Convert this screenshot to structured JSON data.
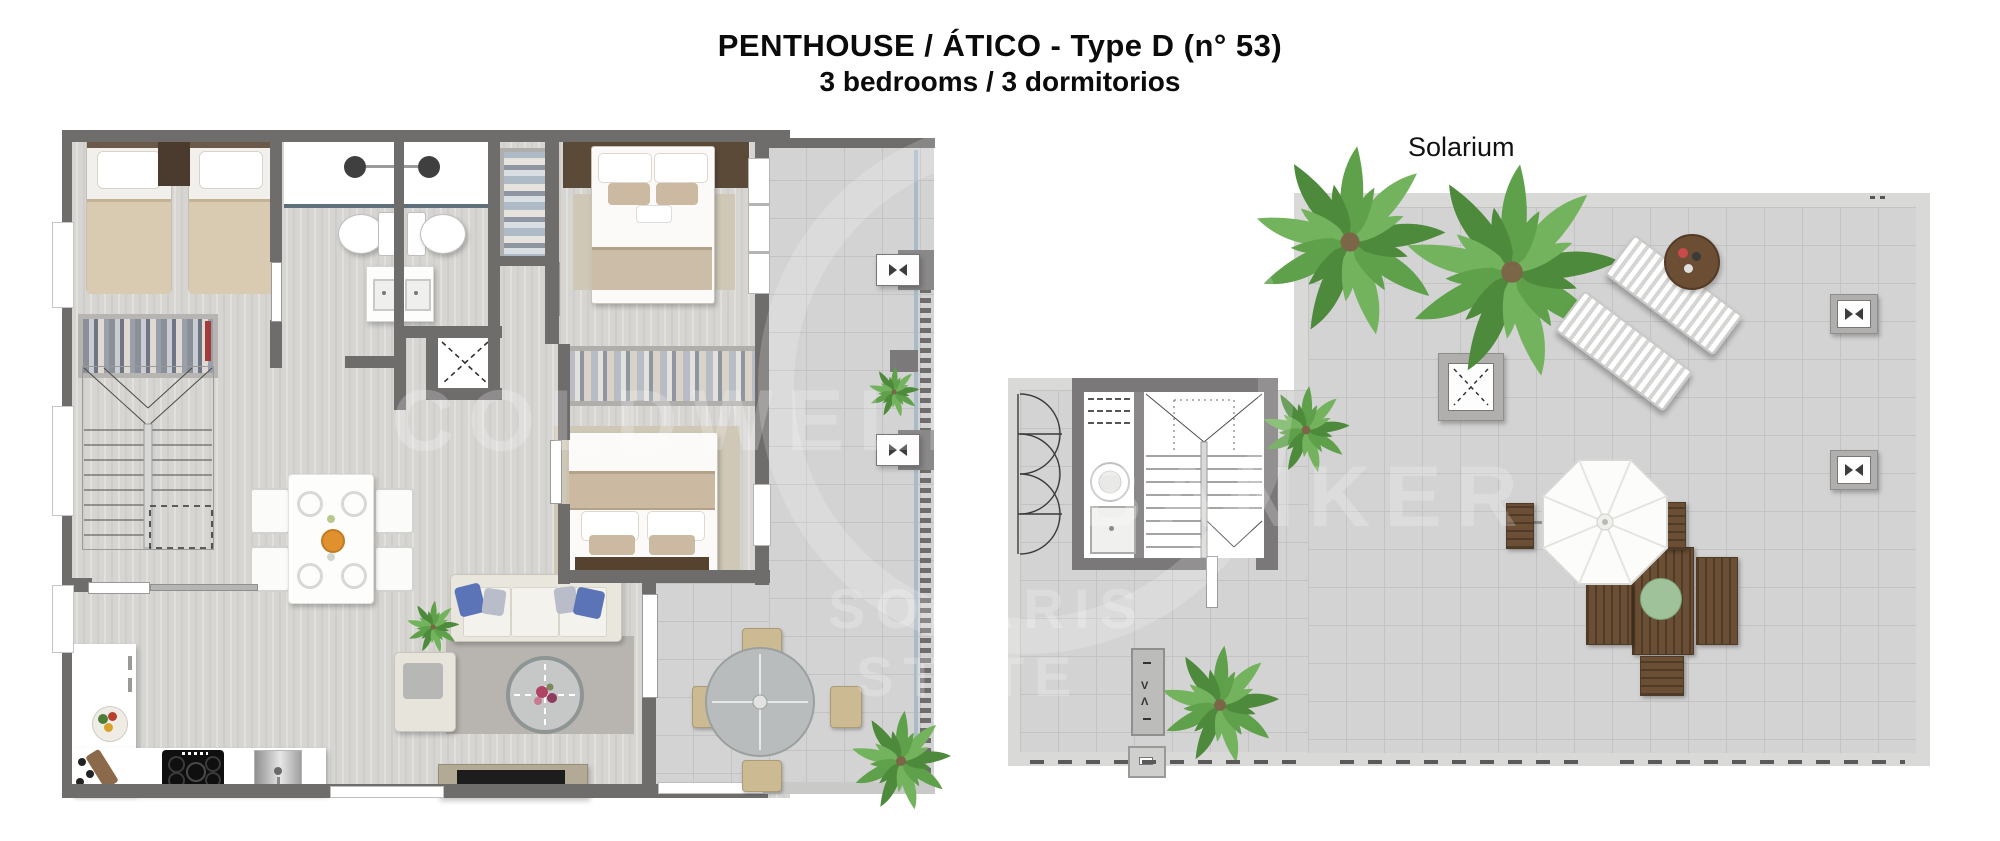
{
  "header": {
    "title": "PENTHOUSE / ÁTICO - Type D (n° 53)",
    "subtitle": "3 bedrooms / 3 dormitorios"
  },
  "solarium": {
    "label": "Solarium"
  },
  "watermark": {
    "line1": "COLDWELL",
    "line2": "BANKER",
    "line3": "SOLARIS",
    "line4": "STATE"
  },
  "colors": {
    "wall_dark": "#6f6c6c",
    "wall_light": "#d9d9d7",
    "wood_floor": "#d6d5d2",
    "tile_floor": "#d3d3d3",
    "bed_duvet_beige": "#d9cbb1",
    "headboard_brown": "#55432f",
    "sofa_pillow_blue": "#5b74b8",
    "outdoor_wood": "#6b4f35",
    "palm_green": "#5e9c49",
    "glass_balustrade": "#a9bcc6",
    "text": "#0b0b0b"
  }
}
